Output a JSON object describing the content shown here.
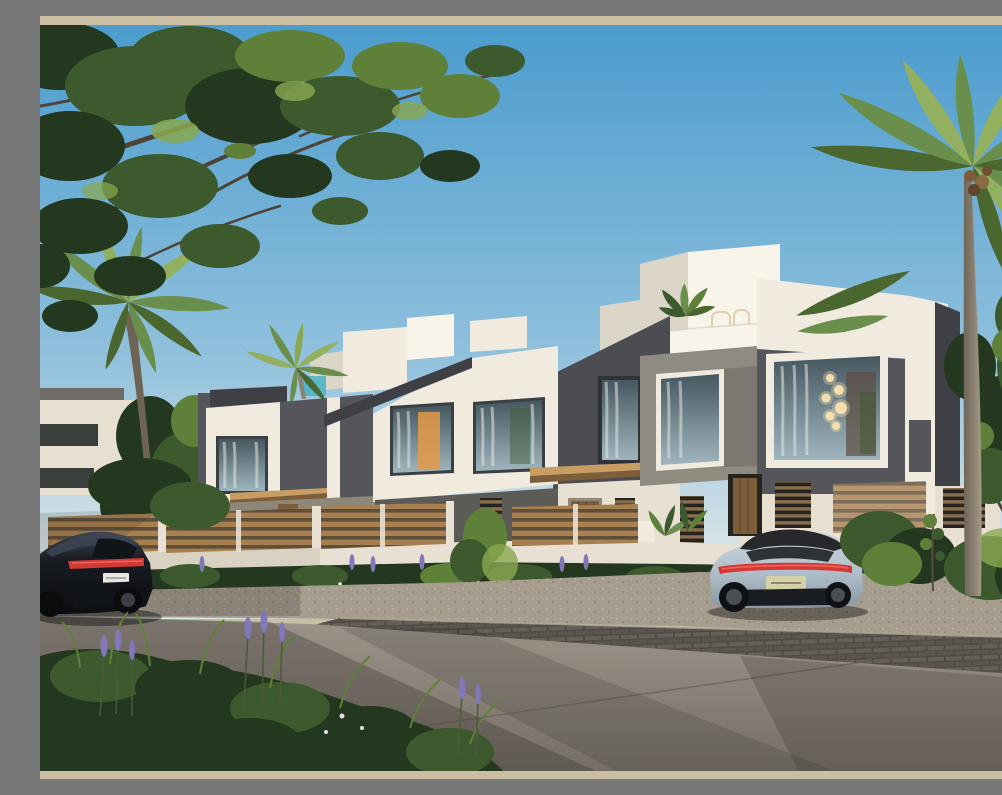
{
  "scene": {
    "setting": "Sunny daytime architectural exterior rendering of a modern two-storey townhouse row with a tan page border",
    "sky": "clear gradient blue sky, no clouds",
    "buildings": {
      "style": "modern boxy townhouses, white stucco volumes with dark grey textured feature panels and wood accents",
      "units_visible": 3,
      "features": [
        "large picture windows with sheer curtains",
        "warm interior light and a cluster of round pendant lamps in the right unit window",
        "rooftop terrace with banana plant, wire chairs and white parapet",
        "wood slat entry canopies and louvered shutters",
        "background second-row rooftops and a small turquoise glass rail"
      ]
    },
    "foreground": {
      "fence": "low white garden wall topped with horizontal wood slat fencing",
      "planting": "lavender spikes, shrubs and white flowers along the wall base",
      "ground": "gravel verge, dark interlocking paver strip and wide concrete road crossed by tree shadows",
      "plants_bottom_left": "tall grasses and purple lavender in shade"
    },
    "vehicles": [
      {
        "name": "black SUV coupe",
        "position": "left, rear three-quarter view, red tail-light bar, licence plate illegible"
      },
      {
        "name": "silver-blue electric sports sedan",
        "position": "right, rear view with full-width red tail-light bar, licence plate illegible"
      }
    ],
    "trees": [
      "large leafy tree canopy overhanging from top left",
      "curved coconut palm on the left",
      "small arching palm behind the middle roofline",
      "tall coconut palm with coconuts on the right",
      "green leafy tree at the far right edge"
    ],
    "visible_text": "none (licence plates are illegible)"
  },
  "frame": {
    "border_sides": "top and bottom",
    "border_color_name": "tan"
  },
  "colors": {
    "frame-tan": "#cabfa3",
    "sky-top": "#4b9cce",
    "sky-mid": "#8fc0dc",
    "sky-low": "#d6e4e7",
    "white-sun": "#f1ebdf",
    "white-shade": "#dcd6c9",
    "white-bright": "#f8f4ea",
    "cream": "#e7dfd0",
    "dark-facade": "#55565c",
    "dark-facade-2": "#4c4d52",
    "dark-cap": "#3f4045",
    "lower-wall": "#8d8779",
    "stucco": "#908b80",
    "wood": "#a87f4f",
    "wood-dark": "#7c5e3a",
    "wood-light": "#c79d64",
    "fence-shadow": "#5e4f3a",
    "glass-top": "#46585f",
    "glass-bot": "#9fb5bd",
    "curtain": "#e4e6e2",
    "warm-light": "#e49a47",
    "pendant": "#f6dfae",
    "teal": "#45b3c6",
    "wall-white": "#e8e0d2",
    "wall-shade": "#cfc6b7",
    "road-light": "#9d948a",
    "road-dark": "#756e65",
    "sidewalk": "#a69d8f",
    "paver": "#4f4b45",
    "paver-light": "#6a635a",
    "green-dark": "#24381f",
    "green-mid": "#3c5a2e",
    "green-light": "#5f8038",
    "green-hi": "#8aa84f",
    "palm": "#6a8f4d",
    "palm-light": "#93b060",
    "palm-dark": "#49672f",
    "trunk": "#8d8272",
    "branch": "#4e4337",
    "lavender": "#8177b9",
    "suv": "#181b20",
    "suv-hi": "#3d4654",
    "sedan": "#b2c1cb",
    "sedan-dark": "#8799a4",
    "sedan-roof": "#26282c",
    "taillight": "#d23a38",
    "shadow": "#2e2b27"
  }
}
